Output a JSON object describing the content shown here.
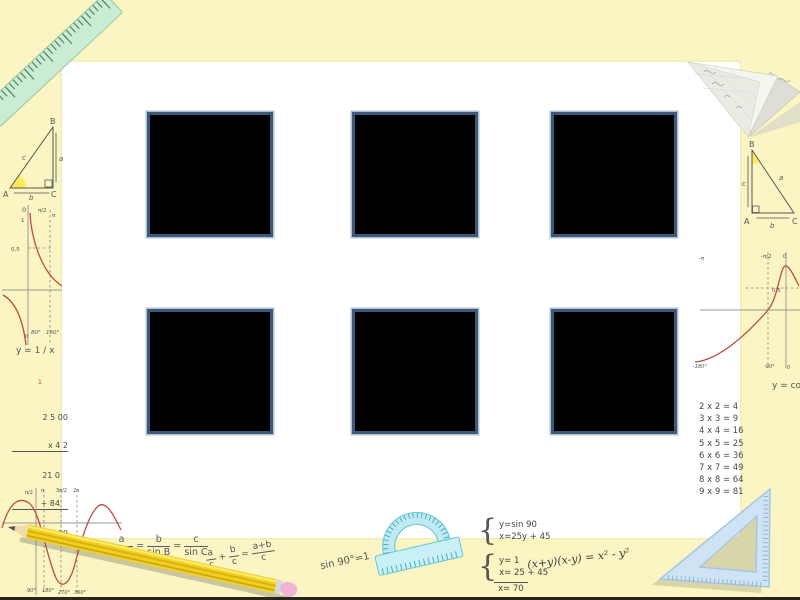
{
  "canvas": {
    "bg": "#FAF5C2",
    "panel_bg": "#FFFFFF",
    "bottom_strip": "#262620"
  },
  "placeholders": {
    "fill": "#000000",
    "border": "#3D5979",
    "count": 6
  },
  "left_triangle": {
    "A": "A",
    "B": "B",
    "C": "C",
    "a": "a",
    "b": "b",
    "c": "c"
  },
  "right_triangle": {
    "A": "A",
    "B": "B",
    "C": "C",
    "a": "a",
    "b": "b",
    "c": "c"
  },
  "reciprocal_graph": {
    "caption": "y = 1 / x",
    "zero_top": "0",
    "one": "1",
    "half": "0,5",
    "pi_half": "π/2",
    "pi": "π",
    "zero_bottom": "0",
    "x1": "80°",
    "x2": "160°",
    "curve_color": "#C24B3F"
  },
  "long_multiplication": {
    "carry": "1",
    "line1": " 2 5 00",
    "line2": "x 4 2",
    "line3": "21 0",
    "line4": "+ 84",
    "result": "105 0 00"
  },
  "sine_graph": {
    "rad_labels": [
      "π/2",
      "π",
      "3π/2",
      "2π"
    ],
    "deg_labels": [
      "90°",
      "180°",
      "270°",
      "360°"
    ],
    "curve_color": "#C24B3F"
  },
  "law_of_sines": {
    "n1": "a",
    "d1": "sin A",
    "eq1": "=",
    "n2": "b",
    "d2": "sin B",
    "eq2": "=",
    "n3": "c",
    "d3": "sin C"
  },
  "fraction_identity": {
    "n1": "a",
    "d1": "c",
    "plus": "+",
    "n2": "b",
    "d2": "c",
    "eq": "=",
    "n3": "a+b",
    "d3": "c"
  },
  "sin90": "sin 90°=1",
  "system1": {
    "line1": "y=sin 90",
    "line2": "x=25y + 45"
  },
  "system2": {
    "line1": "y= 1",
    "line2": "x= 25 + 45",
    "result": "x= 70"
  },
  "difference_of_squares": "(x+y)(x-y) = x² - y²",
  "mult_table": {
    "rows": [
      "2 x 2 = 4",
      "3 x 3 = 9",
      "4 x 4 = 16",
      "5 x 5 = 25",
      "6 x 6 = 36",
      "7 x 7 = 49",
      "8 x 8 = 64",
      "9 x 9 = 81"
    ]
  },
  "cos_graph": {
    "caption": "y = cos x",
    "neg_pi": "-π",
    "neg_pi_half": "-π/2",
    "zero_top": "0",
    "half": "0,5",
    "x_neg180": "-180°",
    "x_neg90": "-90°",
    "x_zero": "0",
    "curve_color": "#C24B3F"
  }
}
